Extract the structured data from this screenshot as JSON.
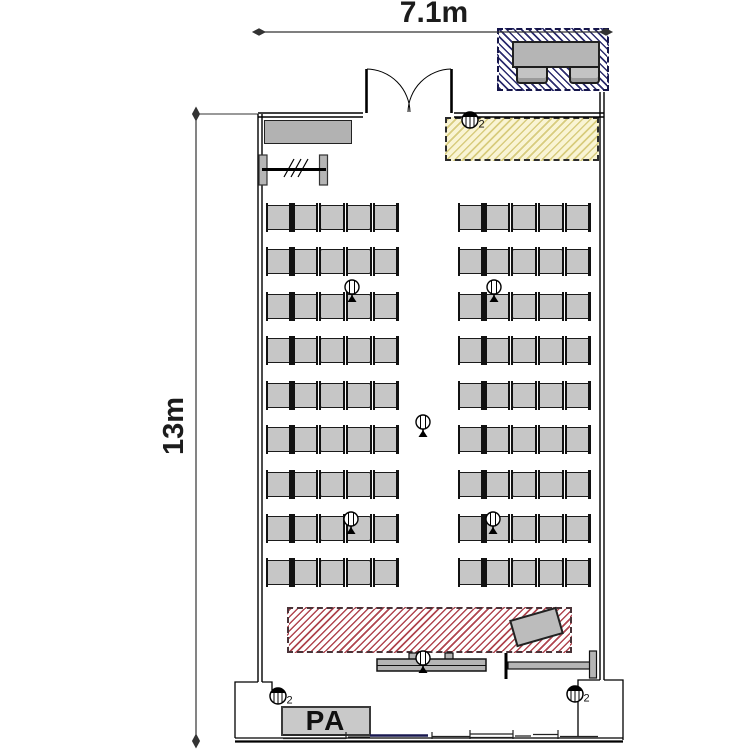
{
  "plan": {
    "width_label": "7.1m",
    "depth_label": "13m",
    "pa_label": "PA",
    "speaker_qty_label": "2"
  },
  "seating": {
    "rows": 9,
    "blocks_per_row": 2,
    "chairs_per_block": 5,
    "total_chairs": 90
  },
  "equipment": {
    "mic_stand_count": 6,
    "speaker_count": 3,
    "entrance_desk_chairs": 2
  },
  "colors": {
    "chair_fill": "#c6c6c6",
    "table_fill": "#b5b5b5",
    "entrance_hatch": "#2c2c6e",
    "rear_zone_fill": "#f9f4d4",
    "rear_zone_hatch": "#d8cc7e",
    "stage_hatch": "#b04650",
    "wall": "#000000"
  }
}
